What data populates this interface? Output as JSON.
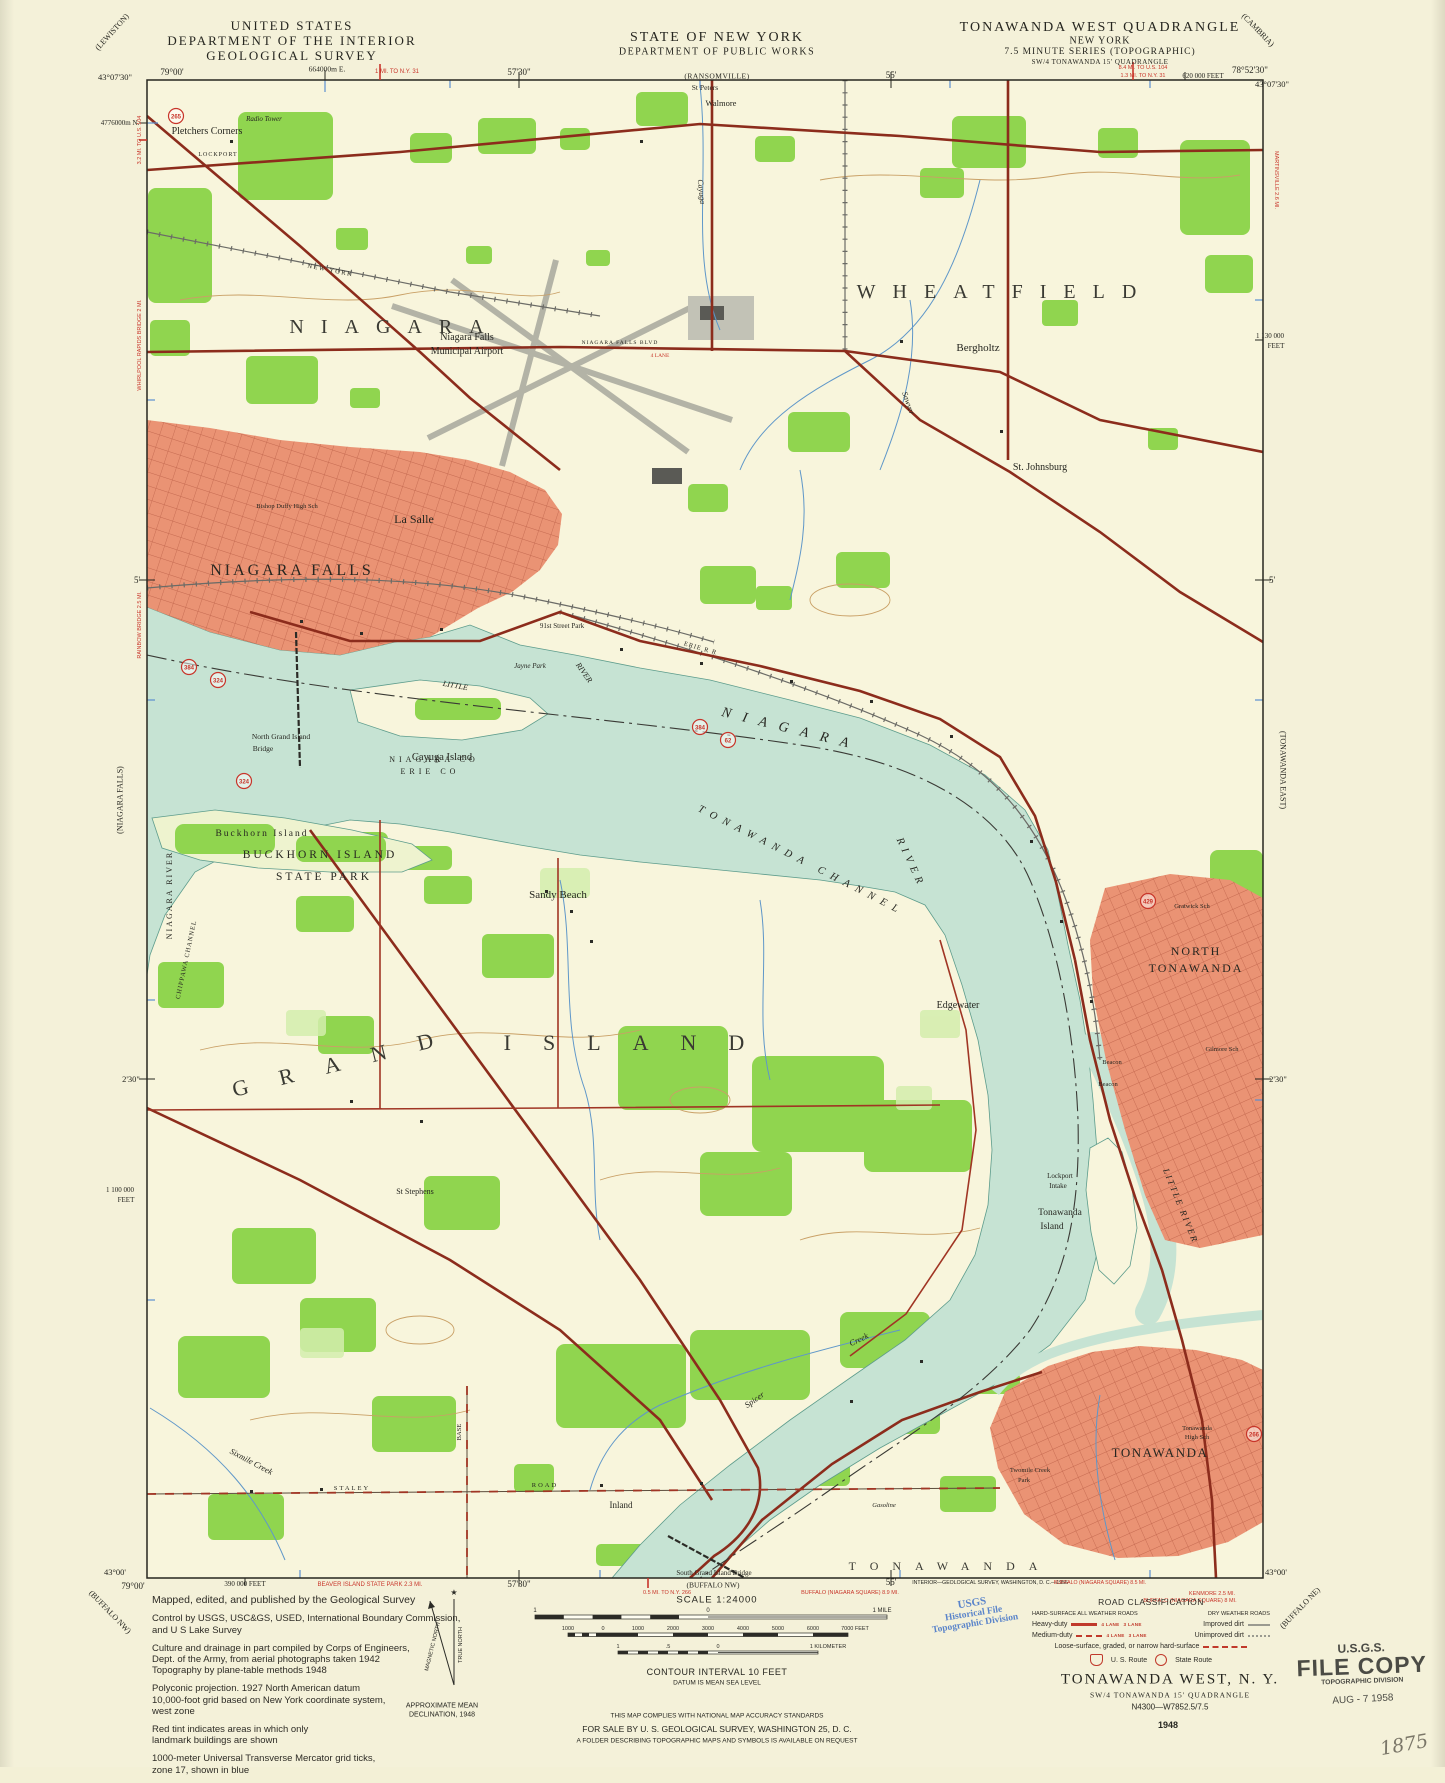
{
  "header": {
    "agency_line1": "UNITED STATES",
    "agency_line2": "DEPARTMENT OF THE INTERIOR",
    "agency_line3": "GEOLOGICAL SURVEY",
    "state_line1": "STATE OF NEW YORK",
    "state_line2": "DEPARTMENT OF PUBLIC WORKS",
    "quad_line1": "TONAWANDA WEST QUADRANGLE",
    "quad_line2": "NEW YORK",
    "quad_line3": "7.5 MINUTE SERIES (TOPOGRAPHIC)",
    "quad_line4": "SW/4 TONAWANDA 15' QUADRANGLE"
  },
  "margins": {
    "top": {
      "nw_lon": "79°00'",
      "nw_lat": "43°07'30\"",
      "utm_e": "664000m E.",
      "red_ny31": "1 MI. TO N.Y. 31",
      "t5730": "57'30\"",
      "ransomville": "(RANSOMVILLE)",
      "t55": "55'",
      "red_us104": "8.4 MI. TO U.S. 104",
      "red_ny31b": "1.3 MI. TO N.Y. 31",
      "feet620": "620 000 FEET",
      "ne_lon": "78°52'30\"",
      "ne_lat": "43°07'30\""
    },
    "left": {
      "lewiston": "(LEWISTON)",
      "utm_n": "4776000m N.",
      "red1": "3.2 MI. TO U.S. 104",
      "red2": "WHIRLPOOL RAPIDS BRIDGE 2 MI.",
      "red3": "RAINBOW BRIDGE 2.5 MI.",
      "five": "5'",
      "niagara_falls": "(NIAGARA FALLS)",
      "t230": "2'30\"",
      "feet1100a": "1 100 000",
      "feet1100b": "FEET",
      "sw_lat": "43°00'",
      "sw_lon": "79°00'",
      "buffalo_nw": "(BUFFALO NW)"
    },
    "right": {
      "cambria": "(CAMBRIA)",
      "feet1130a": "1 130 000",
      "feet1130b": "FEET",
      "martinsville": "MARTINSVILLE 2.6 MI.",
      "five": "5'",
      "tonawanda_east": "(TONAWANDA EAST)",
      "t230": "2'30\"",
      "se_lat": "43°00'",
      "buffalo_ne": "(BUFFALO NE)",
      "kenmore": "KENMORE 2.5 MI.",
      "buffalo8": "BUFFALO (NIAGARA SQUARE) 8 MI."
    },
    "bottom": {
      "feet390": "390 000 FEET",
      "beaver": "BEAVER ISLAND STATE PARK 2.3 MI.",
      "b5730": "57'30\"",
      "buffalo_nw": "(BUFFALO NW)",
      "ny266": "0.5 MI. TO N.Y. 266",
      "buffalo89": "BUFFALO (NIAGARA SQUARE) 8.9 MI.",
      "b55": "55'",
      "interior": "INTERIOR—GEOLOGICAL SURVEY, WASHINGTON, D. C.—1956",
      "buffalo85": "BUFFALO (NIAGARA SQUARE) 8.5 MI."
    }
  },
  "map": {
    "labels": {
      "pletchers": "Pletchers Corners",
      "radio_tower": "Radio Tower",
      "lockport_rd": "LOCKPORT",
      "new_york_rr": "NEW YORK",
      "st_peters": "St Peters",
      "walmore": "Walmore",
      "cayuga_creek": "Cayuga",
      "niagara_town": "NIAGARA",
      "wheatfield": "WHEATFIELD",
      "airport1": "Niagara Falls",
      "airport2": "Municipal Airport",
      "bergholtz": "Bergholtz",
      "sawyer": "Sawyer",
      "st_johnsburg": "St. Johnsburg",
      "la_salle": "La Salle",
      "bishop": "Bishop Duffy High Sch",
      "niagara_falls_city": "NIAGARA FALLS",
      "blvd": "NIAGARA FALLS BLVD",
      "lane4": "4 LANE",
      "park91": "91st Street Park",
      "jayne": "Jayne Park",
      "erie_rr": "ERIE  R R",
      "little1": "LITTLE",
      "river_small": "RIVER",
      "cayuga_island": "Cayuga Island",
      "ngib1": "North Grand Island",
      "ngib2": "Bridge",
      "niagara_co": "NIAGARA  CO",
      "erie_co": "ERIE  CO",
      "river_niagara": "NIAGARA",
      "river_tonawanda": "TONAWANDA  CHANNEL",
      "river_word": "RIVER",
      "buckhorn_small": "Buckhorn Island",
      "buckhorn_big1": "BUCKHORN ISLAND",
      "buckhorn_big2": "STATE PARK",
      "niagara_river_rot": "NIAGARA RIVER",
      "chippawa": "CHIPPAWA CHANNEL",
      "sandy_beach": "Sandy Beach",
      "edgewater": "Edgewater",
      "north1": "NORTH",
      "north2": "TONAWANDA",
      "gratwick": "Gratwick Sch",
      "gilmore": "Gilmore Sch",
      "beacon1": "Beacon",
      "beacon2": "Beacon",
      "lockport1": "Lockport",
      "lockport2": "Intake",
      "ton_island1": "Tonawanda",
      "ton_island2": "Island",
      "little_river_rot": "LITTLE  RIVER",
      "grand": "GRAND",
      "island": "ISLAND",
      "st_stephens": "St Stephens",
      "sixmile": "Sixmile Creek",
      "staley": "STALEY",
      "road": "ROAD",
      "base": "BASE",
      "inland": "Inland",
      "spicer": "Spicer",
      "creek": "Creek",
      "gasoline": "Gasoline",
      "tonawanda_spread": "TONAWANDA",
      "sgib": "South Grand Island Bridge",
      "tonawanda_city": "TONAWANDA",
      "ths1": "Tonawanda",
      "ths2": "High Sch",
      "twomile1": "Twomile Creek",
      "twomile2": "Park"
    },
    "shields": [
      {
        "n": "265"
      },
      {
        "n": "384"
      },
      {
        "n": "324"
      },
      {
        "n": "324"
      },
      {
        "n": "384"
      },
      {
        "n": "62"
      },
      {
        "n": "429"
      },
      {
        "n": "266"
      }
    ],
    "colors": {
      "water": "#c6e3d3",
      "woodland": "#90d54f",
      "urban": "#ea9374",
      "road_heavy": "#8c2c1c",
      "route_red": "#c8352a",
      "contour": "#c9a066",
      "stream_blue": "#5f97c9",
      "grid_blue": "#5b8fd0"
    }
  },
  "footer": {
    "notes": {
      "p1": "Mapped, edited, and published by the Geological Survey",
      "p2": "Control by USGS, USC&GS, USED, International Boundary Commission,\nand U S Lake Survey",
      "p3": "Culture and drainage in part compiled by Corps of Engineers,\nDept. of the Army, from aerial photographs taken 1942\nTopography by plane-table methods 1948",
      "p4": "Polyconic projection.    1927 North American datum\n10,000-foot grid based on New York coordinate system,\nwest zone",
      "p5": "Red tint indicates areas in which only\nlandmark buildings are shown",
      "p6": "1000-meter Universal Transverse Mercator grid ticks,\nzone 17, shown in blue"
    },
    "declination": {
      "tn": "TRUE NORTH",
      "mn": "MAGNETIC NORTH",
      "l1": "APPROXIMATE MEAN",
      "l2": "DECLINATION, 1948"
    },
    "scale_label": "SCALE 1:24000",
    "bars": {
      "mile": [
        "1",
        "0",
        "1 MILE"
      ],
      "feet": [
        "1000",
        "0",
        "1000",
        "2000",
        "3000",
        "4000",
        "5000",
        "6000",
        "7000 FEET"
      ],
      "km": [
        "1",
        ".5",
        "0",
        "1 KILOMETER"
      ]
    },
    "contour": "CONTOUR INTERVAL 10 FEET",
    "datum": "DATUM IS MEAN SEA LEVEL",
    "compliance": "THIS MAP COMPLIES WITH NATIONAL MAP ACCURACY STANDARDS",
    "sale": "FOR SALE BY U. S. GEOLOGICAL SURVEY, WASHINGTON 25, D. C.",
    "folder": "A FOLDER DESCRIBING TOPOGRAPHIC MAPS AND SYMBOLS IS AVAILABLE ON REQUEST",
    "road_class": {
      "title": "ROAD CLASSIFICATION",
      "col1": "HARD-SURFACE ALL WEATHER ROADS",
      "col2": "DRY WEATHER ROADS",
      "heavy": "Heavy-duty",
      "improved": "Improved dirt",
      "medium": "Medium-duty",
      "unimproved": "Unimproved dirt",
      "loose": "Loose-surface, graded, or narrow hard-surface",
      "lane4": "4 LANE",
      "lane3": "3 LANE",
      "us_route": "U. S. Route",
      "state_route": "State Route"
    },
    "title_block": {
      "l1": "TONAWANDA WEST, N. Y.",
      "l2": "SW/4 TONAWANDA 15' QUADRANGLE",
      "l3": "N4300—W7852.5/7.5",
      "year": "1948"
    },
    "stamp_blue": {
      "l1": "USGS",
      "l2": "Historical File",
      "l3": "Topographic Division"
    },
    "stamp_filecopy": {
      "l1": "U.S.G.S.",
      "l2": "FILE COPY",
      "l3": "TOPOGRAPHIC DIVISION",
      "date": "AUG - 7 1958"
    },
    "handwriting": "1875"
  }
}
